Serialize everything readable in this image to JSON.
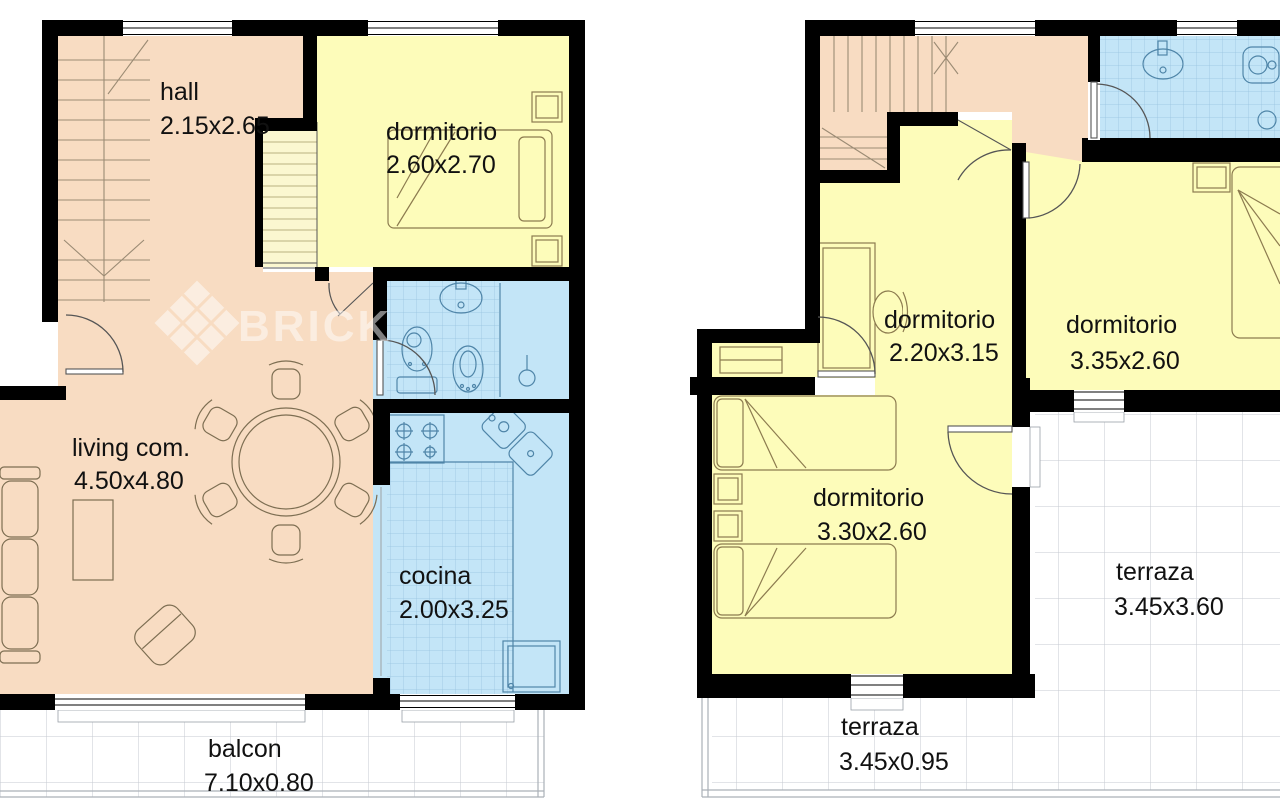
{
  "watermark": {
    "text": "BRICK"
  },
  "colors": {
    "wall": "#000000",
    "room_pink": "#f8dcc2",
    "room_yellow": "#fdfcba",
    "room_pale_yellow": "#fbf7d0",
    "room_blue": "#c3e5f7",
    "tile_grid": "#8ab8d8",
    "outdoor_grid": "#c6cad0",
    "label_text": "#111111",
    "watermark_white": "#ffffff"
  },
  "plans": {
    "left": {
      "rooms": [
        {
          "id": "hall",
          "name": "hall",
          "dims": "2.15x2.65"
        },
        {
          "id": "dormitorio",
          "name": "dormitorio",
          "dims": "2.60x2.70"
        },
        {
          "id": "living",
          "name": "living com.",
          "dims": "4.50x4.80"
        },
        {
          "id": "cocina",
          "name": "cocina",
          "dims": "2.00x3.25"
        },
        {
          "id": "balcon",
          "name": "balcon",
          "dims": "7.10x0.80"
        }
      ]
    },
    "right": {
      "rooms": [
        {
          "id": "dormitorio-1",
          "name": "dormitorio",
          "dims": "2.20x3.15"
        },
        {
          "id": "dormitorio-2",
          "name": "dormitorio",
          "dims": "3.35x2.60"
        },
        {
          "id": "dormitorio-3",
          "name": "dormitorio",
          "dims": "3.30x2.60"
        },
        {
          "id": "terraza-1",
          "name": "terraza",
          "dims": "3.45x3.60"
        },
        {
          "id": "terraza-2",
          "name": "terraza",
          "dims": "3.45x0.95"
        }
      ]
    }
  }
}
